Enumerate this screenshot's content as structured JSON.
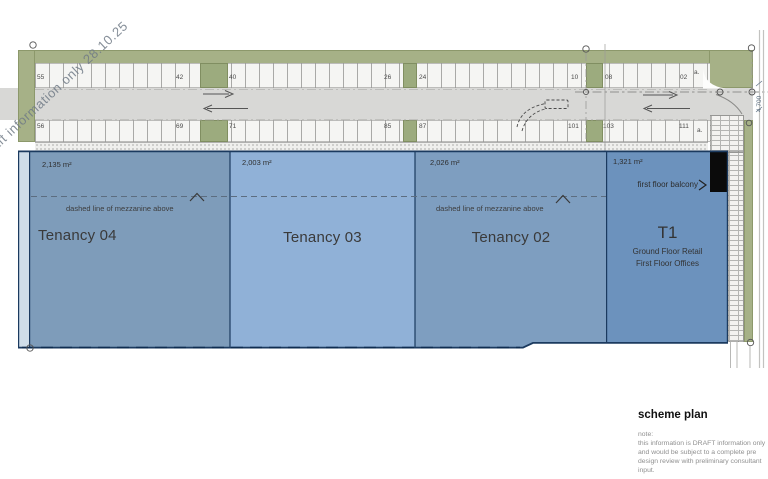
{
  "watermark": "Draft information only 28.10.25",
  "parking": {
    "top_row": [
      {
        "label": "55",
        "x": 37
      },
      {
        "label": "42",
        "x": 176
      },
      {
        "label": "40",
        "x": 229
      },
      {
        "label": "26",
        "x": 384
      },
      {
        "label": "24",
        "x": 419
      },
      {
        "label": "10",
        "x": 571
      },
      {
        "label": "08",
        "x": 605
      },
      {
        "label": "02",
        "x": 680
      },
      {
        "label": "a.",
        "x": 694,
        "y": 69
      }
    ],
    "bottom_row": [
      {
        "label": "56",
        "x": 37
      },
      {
        "label": "69",
        "x": 176
      },
      {
        "label": "71",
        "x": 229
      },
      {
        "label": "85",
        "x": 384
      },
      {
        "label": "87",
        "x": 419
      },
      {
        "label": "101",
        "x": 568
      },
      {
        "label": "103",
        "x": 603
      },
      {
        "label": "111",
        "x": 679
      },
      {
        "label": "a.",
        "x": 697,
        "y": 127
      }
    ]
  },
  "road": {
    "dimension": "4 700"
  },
  "tenancies": [
    {
      "name": "Tenancy 04",
      "area": "2,135 m²",
      "color": "#7e9cba"
    },
    {
      "name": "Tenancy 03",
      "area": "2,003 m²",
      "color": "#90b1d7"
    },
    {
      "name": "Tenancy 02",
      "area": "2,026 m²",
      "color": "#7e9ec0"
    },
    {
      "name": "T1",
      "area": "1,321 m²",
      "color": "#6c92bd",
      "line1": "Ground Floor Retail",
      "line2": "First Floor Offices",
      "balcony_label": "first floor balcony"
    }
  ],
  "annotations": {
    "mezzanine": "dashed line of mezzanine above"
  },
  "titleblock": {
    "title": "scheme plan",
    "note_label": "note:",
    "note_lines": [
      "this information is DRAFT information only",
      "and would be subject to a complete pre",
      "design review with preliminary consultant",
      "input."
    ]
  },
  "colors": {
    "landscape_green": "#a6b187",
    "road_gray": "#d8d8d6",
    "boundary_navy": "#1b3a5f",
    "pale_strip": "#cfdde9"
  }
}
